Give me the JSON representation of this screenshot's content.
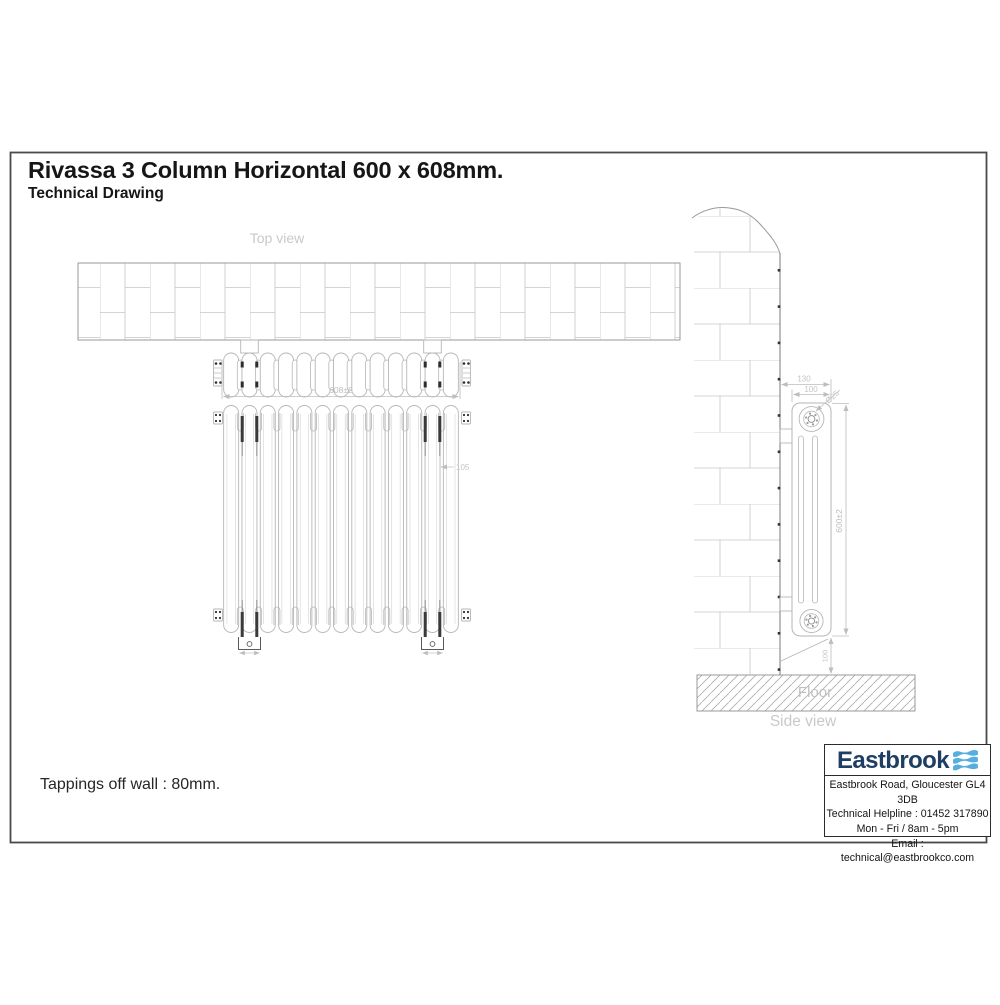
{
  "page": {
    "title": "Rivassa 3 Column Horizontal 600 x 608mm.",
    "subtitle": "Technical Drawing",
    "note": "Tappings off wall : 80mm."
  },
  "labels": {
    "top_view": "Top view",
    "side_view": "Side view",
    "floor": "Floor"
  },
  "dimensions": {
    "width": "608±2",
    "height": "600±2",
    "depth": "100",
    "wall_to_front": "130",
    "column_diameter": "Ø25",
    "floor_clearance": "100",
    "top_offset": "105"
  },
  "info_box": {
    "brand": "Eastbrook",
    "address": "Eastbrook Road, Gloucester GL4 3DB",
    "helpline": "Technical Helpline : 01452 317890",
    "hours": "Mon - Fri / 8am - 5pm",
    "email": "Email : technical@eastbrookco.com"
  },
  "colors": {
    "brand_navy": "#1e3f63",
    "brand_blue": "#54aede",
    "line_gray": "#b6b6b6",
    "brick_gray": "#c6c6c6",
    "wall_edge_gray": "#9a9a9a",
    "dim_gray": "#bdbdbd",
    "label_gray": "#c9c9c9",
    "frame_gray": "#4a4a4a",
    "accent_dark": "#2e2e2e"
  }
}
